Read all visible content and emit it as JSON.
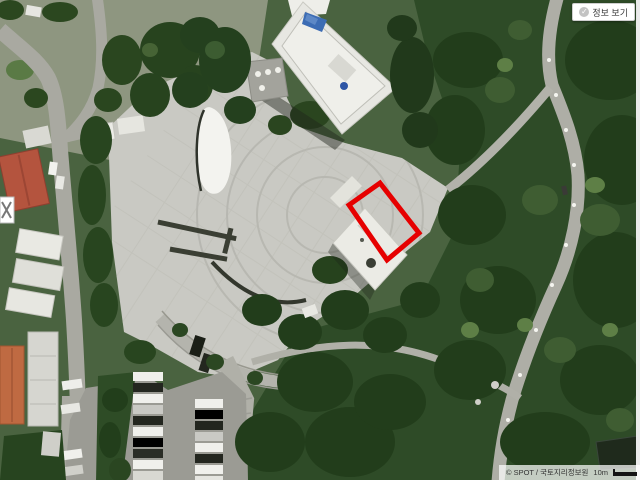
{
  "window": {
    "width_px": 640,
    "height_px": 480
  },
  "map": {
    "view_type": "satellite-orthophoto",
    "info_button": {
      "label": "정보 보기",
      "icon": "✓"
    },
    "attribution": {
      "text": "© SPOT / 국토지리정보원",
      "scale_label": "10m"
    }
  },
  "annotation": {
    "shape": "rotated-rectangle",
    "color": "#e60000",
    "stroke_px": 5
  },
  "colors": {
    "plaza": "#c9c9c3",
    "road": "#a9a9a1",
    "forest_base": "#2e4b27",
    "forest_dark": "#223d1b",
    "button_bg": "#ffffff",
    "attribution_bg": "rgba(255,255,255,0.72)",
    "scalebar": "#141414"
  }
}
